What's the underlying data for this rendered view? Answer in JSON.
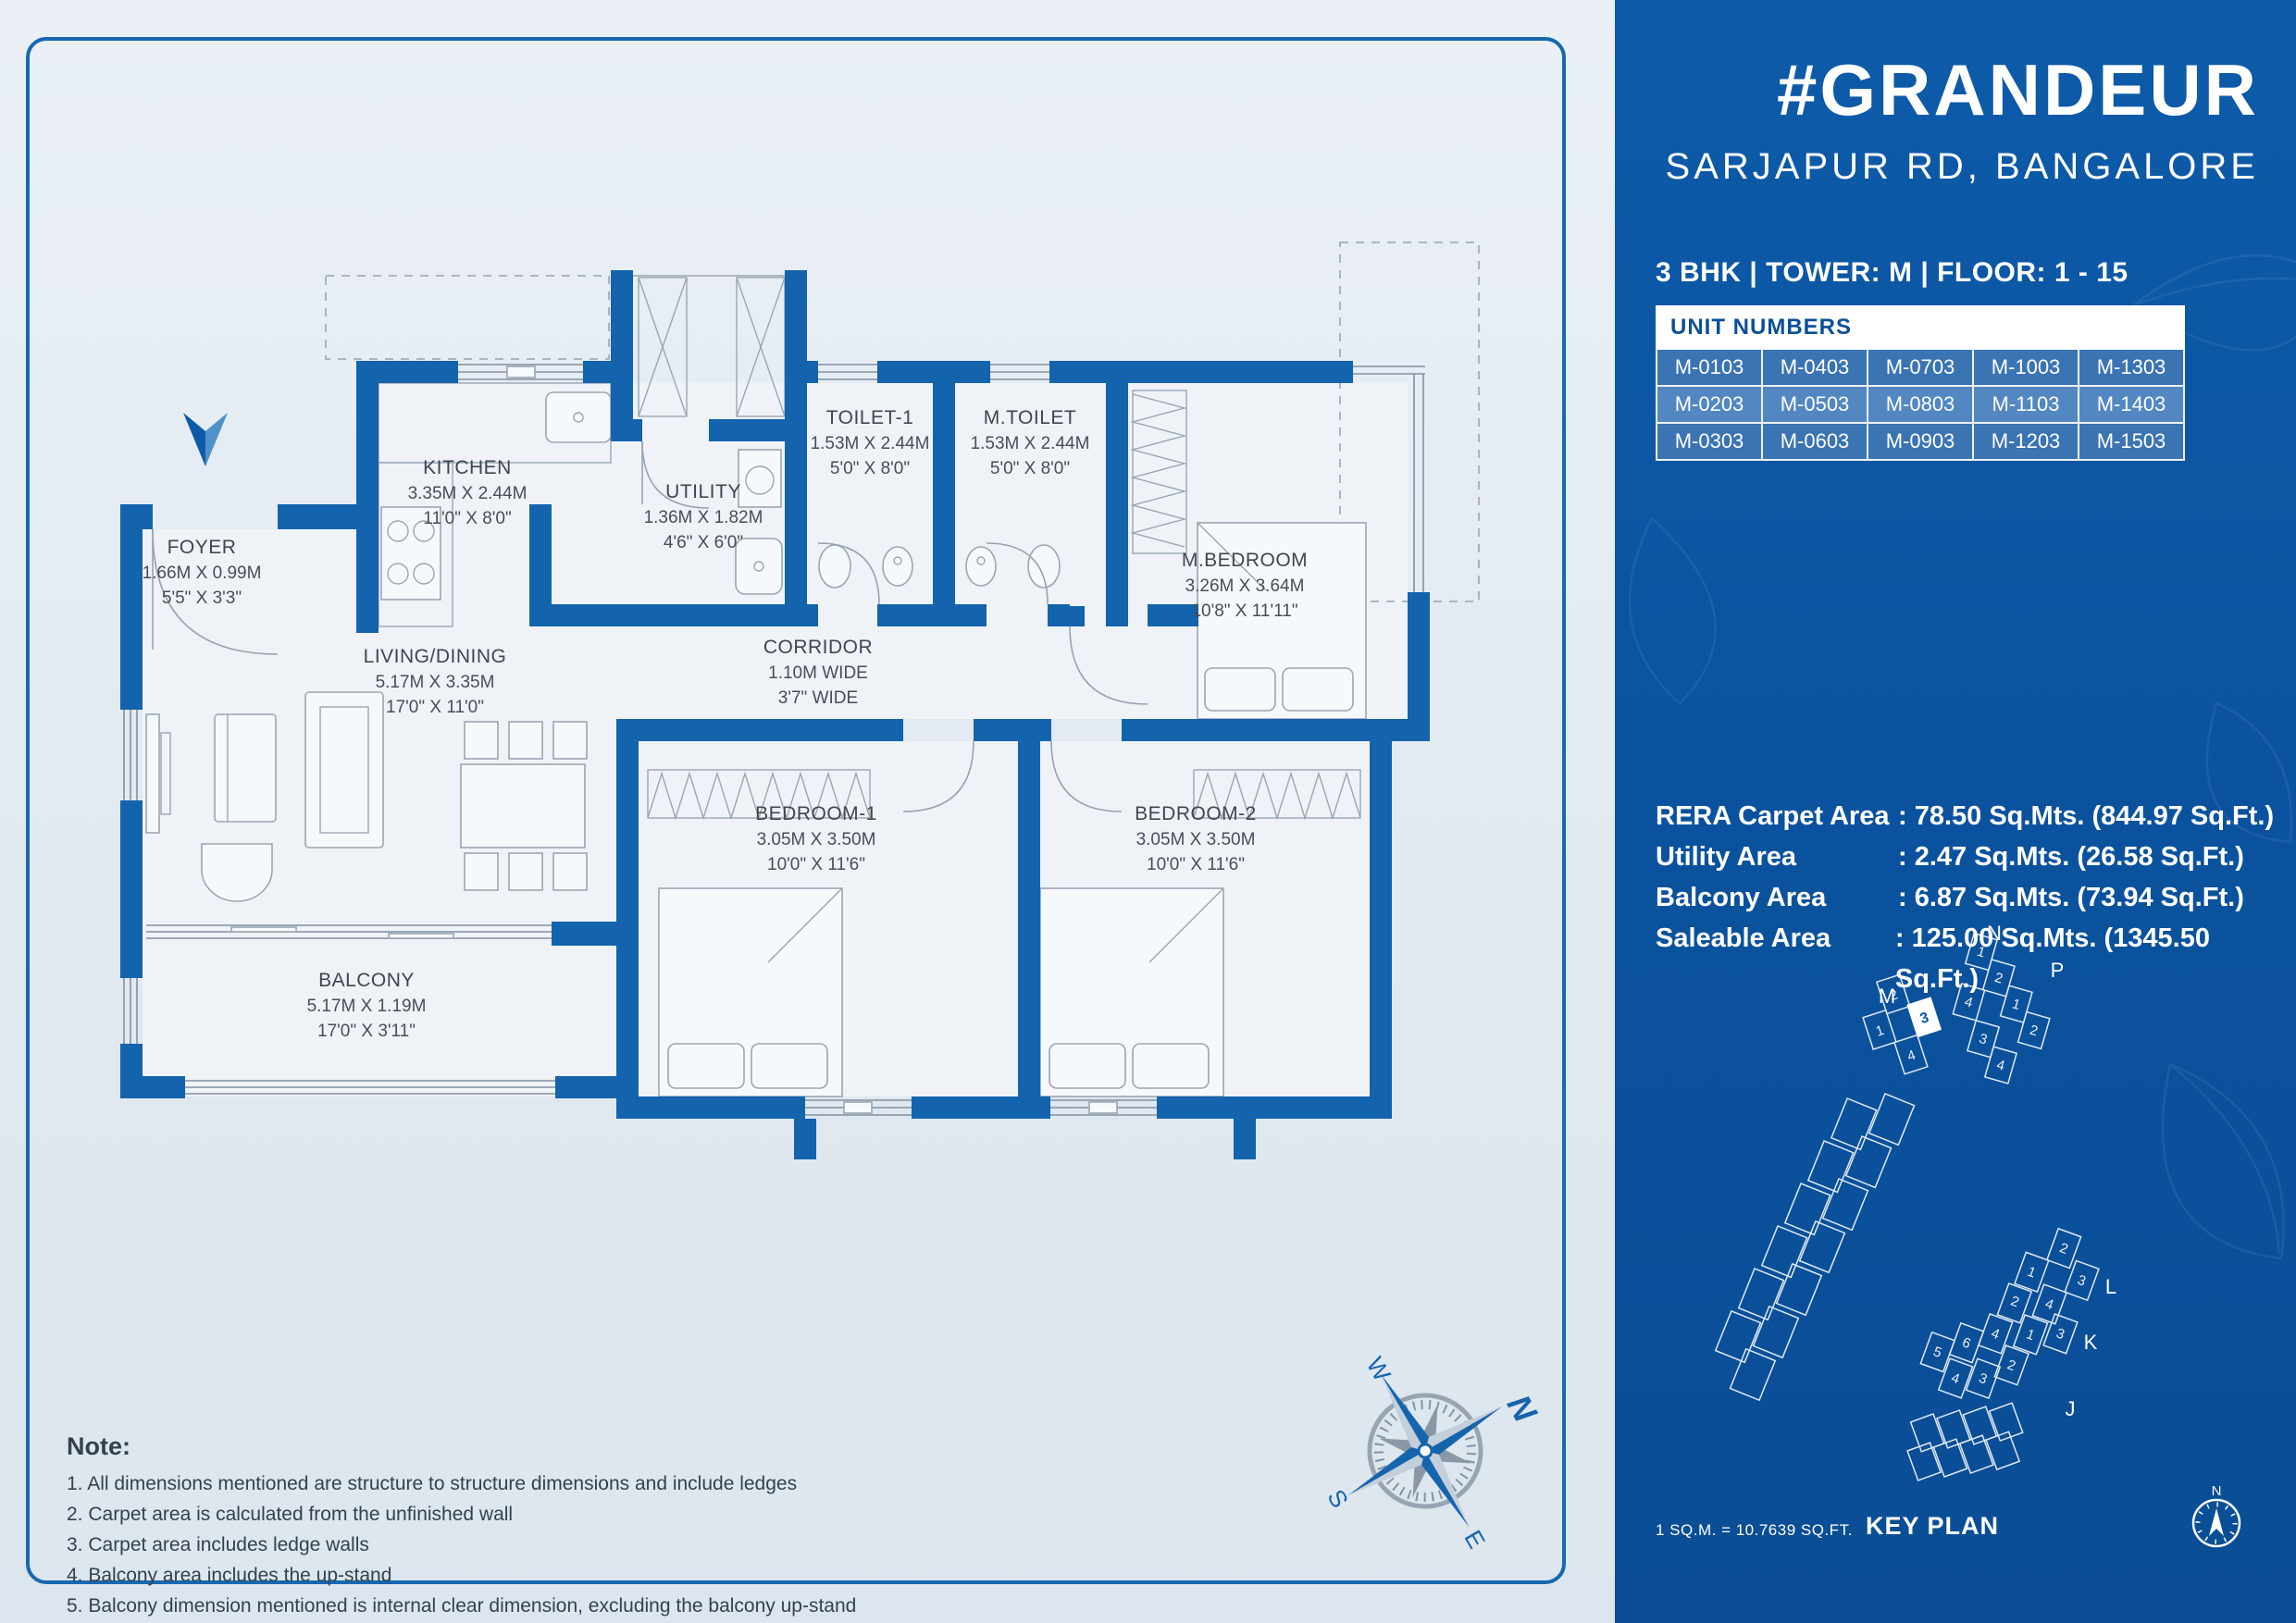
{
  "project": {
    "title": "#GRANDEUR",
    "location": "SARJAPUR RD, BANGALORE",
    "config_line": "3 BHK  |  TOWER: M  |  FLOOR: 1 - 15"
  },
  "unit_table": {
    "header": "UNIT NUMBERS",
    "rows": [
      [
        "M-0103",
        "M-0403",
        "M-0703",
        "M-1003",
        "M-1303"
      ],
      [
        "M-0203",
        "M-0503",
        "M-0803",
        "M-1103",
        "M-1403"
      ],
      [
        "M-0303",
        "M-0603",
        "M-0903",
        "M-1203",
        "M-1503"
      ]
    ]
  },
  "areas": [
    {
      "label": "RERA Carpet Area",
      "value": ": 78.50 Sq.Mts. (844.97 Sq.Ft.)"
    },
    {
      "label": "Utility Area",
      "value": ": 2.47 Sq.Mts. (26.58 Sq.Ft.)"
    },
    {
      "label": "Balcony Area",
      "value": ": 6.87 Sq.Mts. (73.94 Sq.Ft.)"
    },
    {
      "label": "Saleable Area",
      "value": ": 125.00 Sq.Mts. (1345.50 Sq.Ft.)"
    }
  ],
  "rooms": [
    {
      "name": "FOYER",
      "dim_m": "1.66M X 0.99M",
      "dim_ft": "5'5\" X 3'3\""
    },
    {
      "name": "KITCHEN",
      "dim_m": "3.35M X 2.44M",
      "dim_ft": "11'0\" X 8'0\""
    },
    {
      "name": "UTILITY",
      "dim_m": "1.36M X 1.82M",
      "dim_ft": "4'6\" X 6'0\""
    },
    {
      "name": "TOILET-1",
      "dim_m": "1.53M X 2.44M",
      "dim_ft": "5'0\" X 8'0\""
    },
    {
      "name": "M.TOILET",
      "dim_m": "1.53M X 2.44M",
      "dim_ft": "5'0\" X 8'0\""
    },
    {
      "name": "CORRIDOR",
      "dim_m": "1.10M WIDE",
      "dim_ft": "3'7\" WIDE"
    },
    {
      "name": "LIVING/DINING",
      "dim_m": "5.17M X 3.35M",
      "dim_ft": "17'0\" X 11'0\""
    },
    {
      "name": "M.BEDROOM",
      "dim_m": "3.26M X 3.64M",
      "dim_ft": "10'8\" X 11'11\""
    },
    {
      "name": "BEDROOM-1",
      "dim_m": "3.05M X 3.50M",
      "dim_ft": "10'0\" X 11'6\""
    },
    {
      "name": "BEDROOM-2",
      "dim_m": "3.05M X 3.50M",
      "dim_ft": "10'0\" X 11'6\""
    },
    {
      "name": "BALCONY",
      "dim_m": "5.17M X 1.19M",
      "dim_ft": "17'0\" X 3'11\""
    }
  ],
  "notes": {
    "title": "Note:",
    "items": [
      "1. All dimensions mentioned are structure to structure dimensions and include ledges",
      "2. Carpet area is calculated from the unfinished wall",
      "3. Carpet area includes ledge walls",
      "4. Balcony area includes the up-stand",
      "5. Balcony dimension mentioned is internal clear dimension, excluding the balcony up-stand"
    ]
  },
  "footer": {
    "scale_note": "1 SQ.M. = 10.7639 SQ.FT.",
    "key_plan_label": "KEY PLAN"
  },
  "compass": {
    "n": "N",
    "e": "E",
    "s": "S",
    "w": "W"
  },
  "key_plan": {
    "towers": {
      "m": "M",
      "n": "N",
      "p": "P",
      "l": "L",
      "k": "K",
      "j": "J"
    },
    "highlighted_unit": "3",
    "unit_labels": [
      "1",
      "2",
      "3",
      "4",
      "5",
      "6"
    ]
  },
  "colors": {
    "panel_blue": "#0c58a4",
    "wall_blue": "#1363ad",
    "accent_light": "#4189cc"
  }
}
